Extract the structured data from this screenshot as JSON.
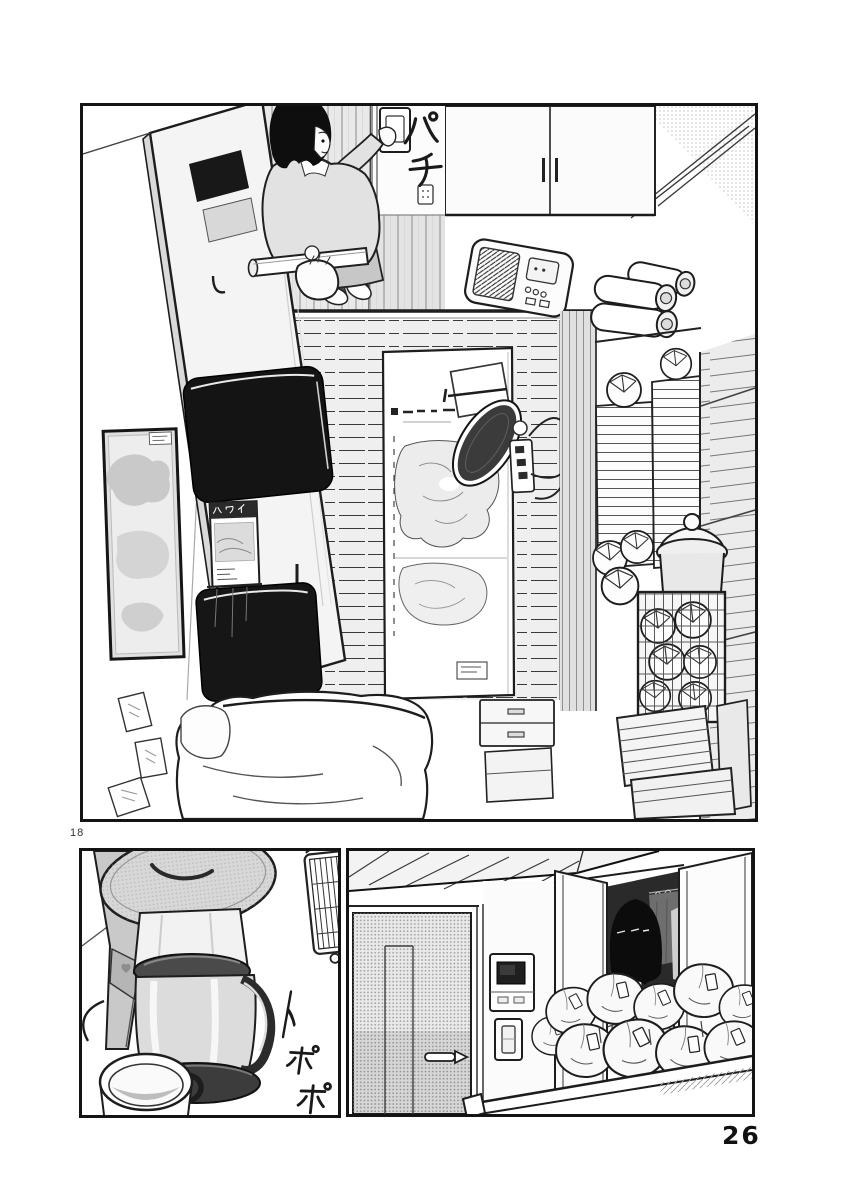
{
  "page": {
    "paper_color": "#ffffff",
    "ink_color": "#1c1c1c",
    "folio_left": "18",
    "folio_right": "26"
  },
  "panels": {
    "room_overhead": {
      "sfx_light_switch": "パチ",
      "guidebook_title": "ハワイ"
    },
    "coffee_maker": {
      "sfx_pouring": "トポポ"
    }
  }
}
